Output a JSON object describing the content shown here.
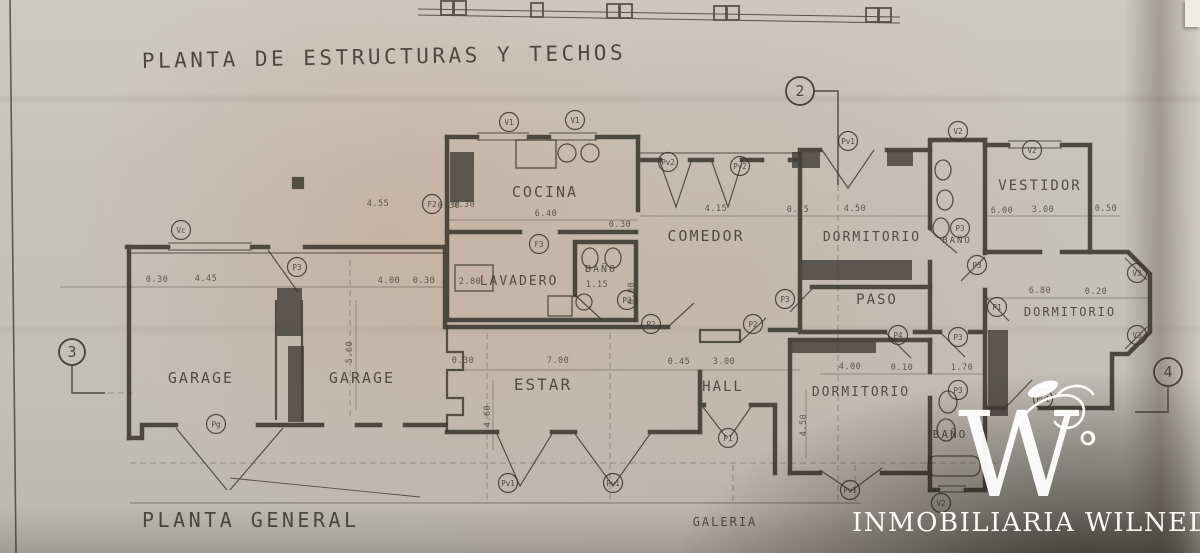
{
  "titles": {
    "main": "PLANTA DE ESTRUCTURAS Y TECHOS",
    "plan": "PLANTA GENERAL"
  },
  "watermark": {
    "monogram": "W",
    "brand": "INMOBILIARIA WILNEDER"
  },
  "colors": {
    "ink": "#3a362e",
    "paper": "#c6c3bc",
    "warm_tint": "#cb9572",
    "watermark_white": "#ffffff"
  },
  "rooms": [
    {
      "label": "COCINA",
      "x": 545,
      "y": 197,
      "s": 15
    },
    {
      "label": "LAVADERO",
      "x": 519,
      "y": 285,
      "s": 13
    },
    {
      "label": "BAÑO",
      "x": 601,
      "y": 272,
      "s": 10
    },
    {
      "label": "COMEDOR",
      "x": 706,
      "y": 241,
      "s": 15
    },
    {
      "label": "DORMITORIO",
      "x": 872,
      "y": 241,
      "s": 13
    },
    {
      "label": "BAÑO",
      "x": 957,
      "y": 243,
      "s": 9
    },
    {
      "label": "VESTIDOR",
      "x": 1040,
      "y": 190,
      "s": 14
    },
    {
      "label": "PASO",
      "x": 877,
      "y": 304,
      "s": 14
    },
    {
      "label": "DORMITORIO",
      "x": 1070,
      "y": 316,
      "s": 12
    },
    {
      "label": "GARAGE",
      "x": 201,
      "y": 383,
      "s": 15
    },
    {
      "label": "GARAGE",
      "x": 362,
      "y": 383,
      "s": 15
    },
    {
      "label": "ESTAR",
      "x": 543,
      "y": 390,
      "s": 16
    },
    {
      "label": "HALL",
      "x": 723,
      "y": 391,
      "s": 14
    },
    {
      "label": "DORMITORIO",
      "x": 861,
      "y": 396,
      "s": 13
    },
    {
      "label": "BAÑO",
      "x": 950,
      "y": 438,
      "s": 11
    },
    {
      "label": "GALERIA",
      "x": 725,
      "y": 526,
      "s": 12
    }
  ],
  "section_markers": [
    {
      "label": "2",
      "x": 800,
      "y": 91,
      "r": 14
    },
    {
      "label": "3",
      "x": 72,
      "y": 352,
      "r": 13
    },
    {
      "label": "4",
      "x": 1168,
      "y": 372,
      "r": 14
    }
  ],
  "openings": [
    {
      "label": "V1",
      "x": 509,
      "y": 122
    },
    {
      "label": "V1",
      "x": 575,
      "y": 120
    },
    {
      "label": "F2",
      "x": 432,
      "y": 204
    },
    {
      "label": "F3",
      "x": 539,
      "y": 244
    },
    {
      "label": "Pv2",
      "x": 668,
      "y": 162
    },
    {
      "label": "Pv2",
      "x": 740,
      "y": 166
    },
    {
      "label": "Pv1",
      "x": 848,
      "y": 141
    },
    {
      "label": "V2",
      "x": 958,
      "y": 131
    },
    {
      "label": "V2",
      "x": 1032,
      "y": 150
    },
    {
      "label": "P3",
      "x": 960,
      "y": 228
    },
    {
      "label": "P3",
      "x": 977,
      "y": 265
    },
    {
      "label": "P1",
      "x": 997,
      "y": 307
    },
    {
      "label": "V3",
      "x": 1137,
      "y": 273
    },
    {
      "label": "V3",
      "x": 1137,
      "y": 335
    },
    {
      "label": "P3",
      "x": 627,
      "y": 300
    },
    {
      "label": "P2",
      "x": 651,
      "y": 324
    },
    {
      "label": "P2",
      "x": 753,
      "y": 324
    },
    {
      "label": "P3",
      "x": 785,
      "y": 299
    },
    {
      "label": "P4",
      "x": 898,
      "y": 335
    },
    {
      "label": "P3",
      "x": 958,
      "y": 337
    },
    {
      "label": "P3",
      "x": 958,
      "y": 390
    },
    {
      "label": "Pv1",
      "x": 1043,
      "y": 399
    },
    {
      "label": "V2",
      "x": 941,
      "y": 503
    },
    {
      "label": "Pv1",
      "x": 850,
      "y": 490
    },
    {
      "label": "Vc",
      "x": 181,
      "y": 230
    },
    {
      "label": "P3",
      "x": 297,
      "y": 267
    },
    {
      "label": "Pg",
      "x": 216,
      "y": 424
    },
    {
      "label": "Pv1",
      "x": 508,
      "y": 483
    },
    {
      "label": "Pv1",
      "x": 613,
      "y": 483
    },
    {
      "label": "P1",
      "x": 728,
      "y": 438
    }
  ],
  "dimensions": [
    {
      "t": "0.30",
      "x": 464,
      "y": 207,
      "r": 0
    },
    {
      "t": "6.40",
      "x": 546,
      "y": 216,
      "r": 0
    },
    {
      "t": "0.30",
      "x": 620,
      "y": 227,
      "r": 0
    },
    {
      "t": "4.55",
      "x": 378,
      "y": 206,
      "r": 0
    },
    {
      "t": "0.30",
      "x": 449,
      "y": 208,
      "r": 0
    },
    {
      "t": "4.15",
      "x": 716,
      "y": 211,
      "r": 0
    },
    {
      "t": "0.15",
      "x": 798,
      "y": 212,
      "r": 0
    },
    {
      "t": "4.50",
      "x": 855,
      "y": 211,
      "r": 0
    },
    {
      "t": "6.00",
      "x": 1002,
      "y": 213,
      "r": 0
    },
    {
      "t": "3.00",
      "x": 1043,
      "y": 212,
      "r": 0
    },
    {
      "t": "0.50",
      "x": 1106,
      "y": 211,
      "r": 0
    },
    {
      "t": "6.80",
      "x": 1040,
      "y": 293,
      "r": 0
    },
    {
      "t": "0.20",
      "x": 1096,
      "y": 294,
      "r": 0
    },
    {
      "t": "4.00",
      "x": 850,
      "y": 369,
      "r": 0
    },
    {
      "t": "0.10",
      "x": 902,
      "y": 370,
      "r": 0
    },
    {
      "t": "1.70",
      "x": 962,
      "y": 370,
      "r": 0
    },
    {
      "t": "0.30",
      "x": 157,
      "y": 282,
      "r": 0
    },
    {
      "t": "4.45",
      "x": 206,
      "y": 281,
      "r": 0
    },
    {
      "t": "4.00",
      "x": 389,
      "y": 283,
      "r": 0
    },
    {
      "t": "0.30",
      "x": 424,
      "y": 283,
      "r": 0
    },
    {
      "t": "5.60",
      "x": 352,
      "y": 352,
      "r": -90
    },
    {
      "t": "0.30",
      "x": 463,
      "y": 363,
      "r": 0
    },
    {
      "t": "7.00",
      "x": 558,
      "y": 363,
      "r": 0
    },
    {
      "t": "0.45",
      "x": 679,
      "y": 364,
      "r": 0
    },
    {
      "t": "3.00",
      "x": 724,
      "y": 364,
      "r": 0
    },
    {
      "t": "4.60",
      "x": 490,
      "y": 416,
      "r": -90
    },
    {
      "t": "4.50",
      "x": 806,
      "y": 425,
      "r": -90
    },
    {
      "t": "2.80",
      "x": 470,
      "y": 284,
      "r": 0
    },
    {
      "t": "1.15",
      "x": 597,
      "y": 287,
      "r": 0
    },
    {
      "t": "6.00",
      "x": 634,
      "y": 293,
      "r": -90
    }
  ]
}
